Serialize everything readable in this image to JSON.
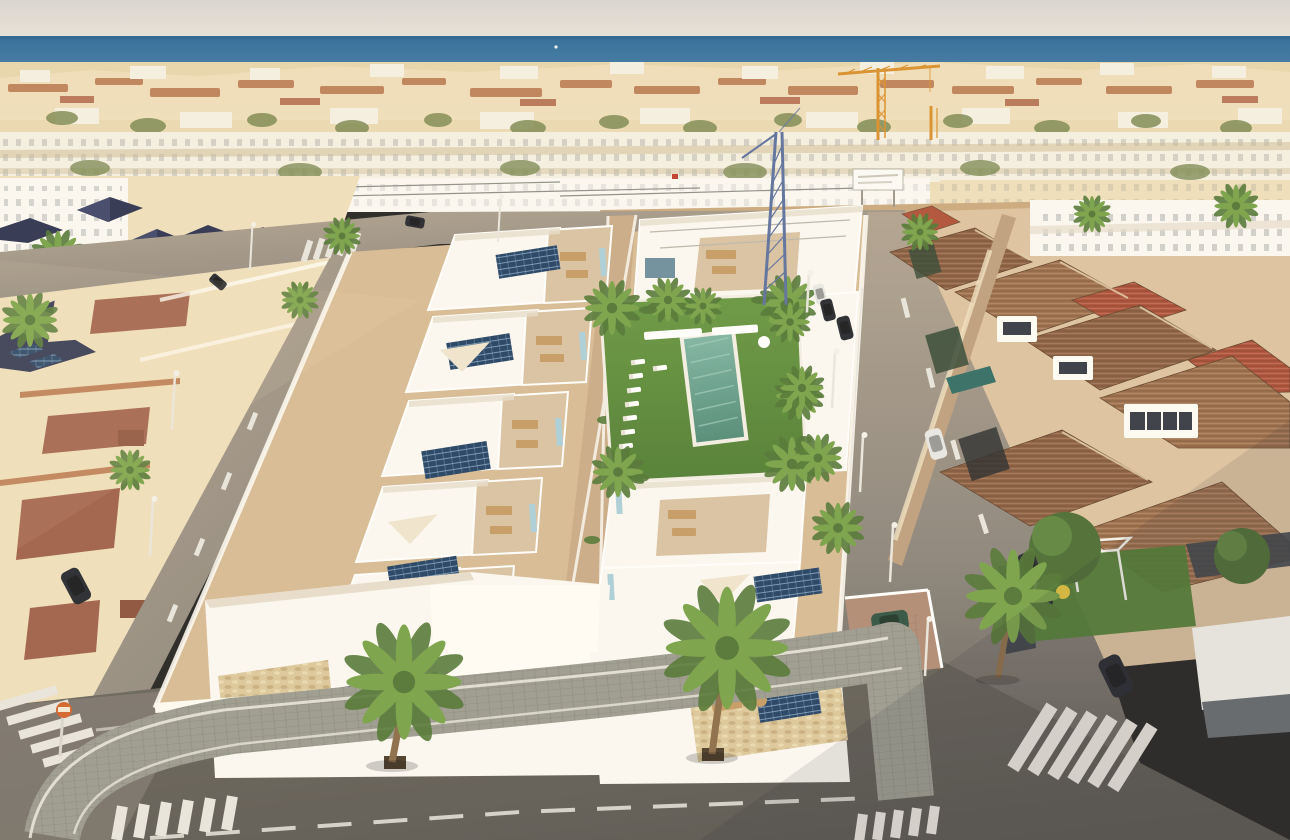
{
  "scene": {
    "description": "Aerial 3D render of a new-build complex of white flat-roof villas with solar panels and a communal pool, set inside an existing Mediterranean beach town, sea on the horizon",
    "setting": {
      "time_of_day": "late afternoon sun from the left",
      "horizon": "sea band under pale sky",
      "landmarks": [
        "orange tower crane",
        "blue lattice crane",
        "white billboard on empty dirt lot"
      ]
    },
    "new_development": {
      "villa_rows": 2,
      "features": [
        "white parapet roofs",
        "beige roof terraces with wooden furniture",
        "dark blue photovoltaic panels",
        "light-blue glass balustrades",
        "central pedestrian walkway",
        "cream shade sails"
      ],
      "communal_area": {
        "pool": 1,
        "lawn": true,
        "sun_loungers": 8,
        "white_benches": 2,
        "palm_trees": 7
      },
      "flag_color_hint": "small red flag on scaffolding"
    },
    "left_neighborhood": {
      "style": "cream villas, dark navy pyramid roofs, terracotta-capped parapet walls, one roof with solar panels"
    },
    "right_neighborhood": {
      "style": "beige villas with brown and red terracotta tiled roofs, white dormers and glazed conservatory, private plunge pool, garden with white pergola and yellow parasol"
    },
    "distant_town": {
      "style": "dense low white and cream houses, terracotta roof strips, scattered palms, rows of white townhouses mid-ground"
    },
    "streets": {
      "crosswalks": 6,
      "street_lamps": 9,
      "lane_markings": "white dashes and edge lines",
      "sign": "orange circular traffic sign on pole",
      "parked_cars": {
        "dark": 5,
        "white": 3,
        "green": 1
      },
      "sidewalk": "grey block pavers wrapping the corner, palms planted in pits"
    },
    "palette": {
      "sky_top": "#d8d5d2",
      "sky_bottom": "#e7e3db",
      "sea_deep": "#2a6899",
      "sea_mid": "#3f7ba7",
      "sea_light": "#7ba6c1",
      "town_base": "#e7d5ac",
      "town_cream": "#eedfbd",
      "town_white": "#f5f0e3",
      "town_shadow": "#c9b690",
      "roof_terracotta_far": "#b5724b",
      "roof_red_far": "#a85a40",
      "roof_navy": "#2b3150",
      "green_tree": "#7b8852",
      "palm_dark": "#4f7534",
      "palm_light": "#76a248",
      "trunk": "#8a6b4a",
      "dirt": "#c9a87d",
      "dirt_light": "#d5bb95",
      "villa_white": "#fbf9f4",
      "villa_bright": "#fffdf8",
      "villa_shadow": "#e6ddcd",
      "villa_grey": "#d8d2c6",
      "terrace": "#d9c2a4",
      "terrace_dark": "#c4a685",
      "terrace_warm": "#e4cdb0",
      "solar": "#1f3f63",
      "solar_light": "#4a7aa6",
      "accent_blue": "#8fbccc",
      "glass_blue": "#a9cfdb",
      "pool_water": "#4f8a78",
      "pool_light": "#7db4a4",
      "lawn": "#669741",
      "lawn_dark": "#4e7c33",
      "wood": "#c49a64",
      "stone": "#dcc89d",
      "shade_sail": "#efe5d0",
      "road_lit": "#b0a291",
      "road_mid": "#8a847c",
      "road_dark": "#565450",
      "asphalt_shadow": "#6b675f",
      "sidewalk": "#999a90",
      "sidewalk_dark": "#83857b",
      "curb": "#e9e6dd",
      "stripe": "#e8e6df",
      "r_roof_brown": "#8c5f41",
      "r_roof_brown2": "#9d6e4c",
      "r_roof_red": "#ad4f37",
      "r_wall": "#dcc2a0",
      "r_wall_shadow": "#bd9f7e",
      "crane_orange": "#d98f2b",
      "crane_blue": "#5a6f9e",
      "car_dark": "#23262e",
      "car_white": "#e8e8e6",
      "car_green": "#2e5242",
      "sign_orange": "#d2622a",
      "fence_dark": "#3a4048",
      "flag_red": "#c03a2a"
    }
  }
}
